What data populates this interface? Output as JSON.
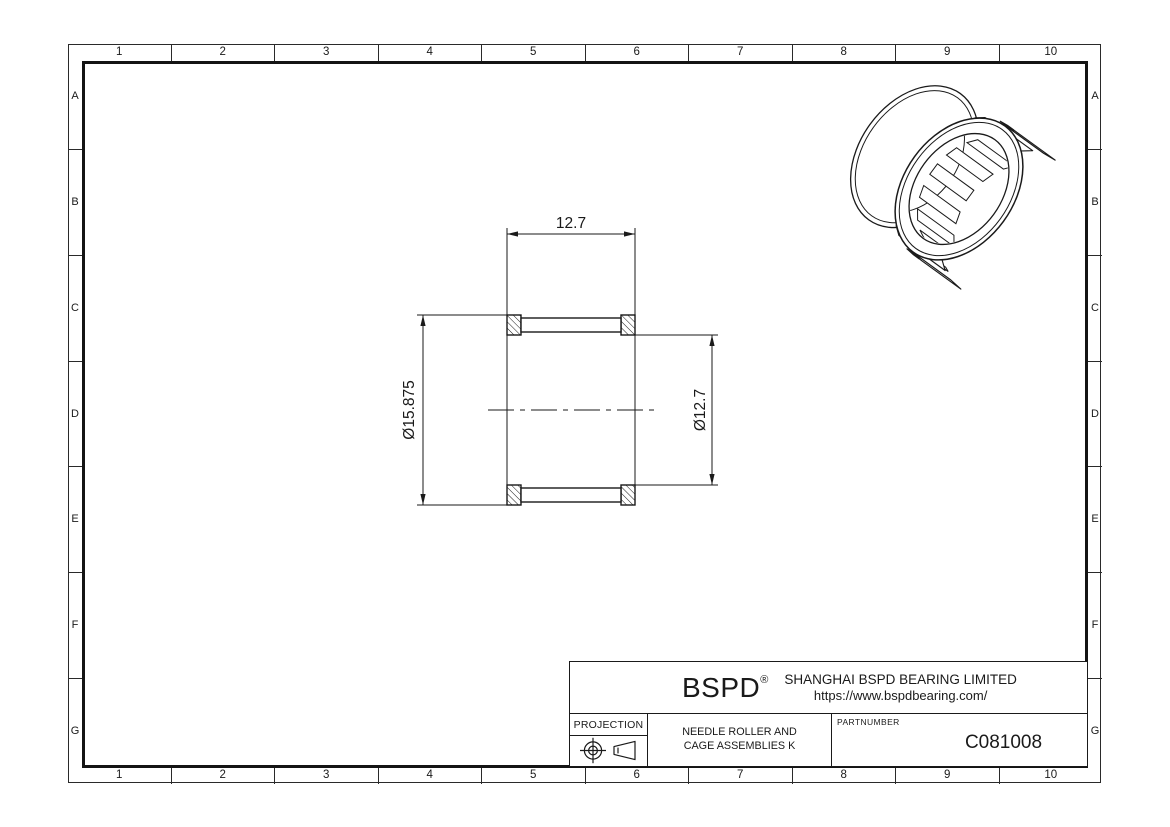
{
  "grid": {
    "columns": [
      "1",
      "2",
      "3",
      "4",
      "5",
      "6",
      "7",
      "8",
      "9",
      "10"
    ],
    "rows": [
      "A",
      "B",
      "C",
      "D",
      "E",
      "F",
      "G"
    ]
  },
  "drawing_view": {
    "width_dim": "12.7",
    "outer_diameter_dim": "Ø15.875",
    "inner_diameter_dim": "Ø12.7"
  },
  "title_block": {
    "logo_text": "BSPD",
    "registered_mark": "®",
    "company_name": "SHANGHAI BSPD BEARING LIMITED",
    "website": "https://www.bspdbearing.com/",
    "projection_label": "PROJECTION",
    "product_title_line1": "NEEDLE ROLLER AND",
    "product_title_line2": "CAGE ASSEMBLIES K",
    "part_number_label": "PARTNUMBER",
    "part_number": "C081008"
  },
  "colors": {
    "line": "#1a1a1a",
    "background": "#ffffff"
  }
}
